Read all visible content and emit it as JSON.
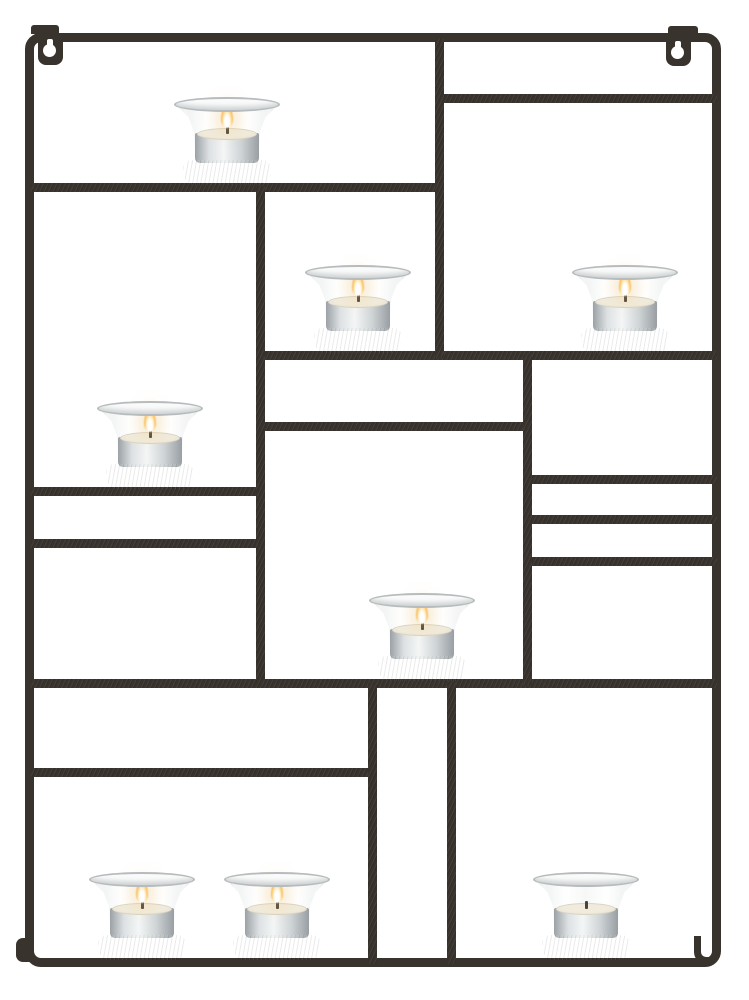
{
  "scene": {
    "description": "Wall-mounted dark metal tealight candle holder with a rectangular Mondrian-style grid frame, two keyhole wall hangers at the top, and eight clear glass votive cups on small shelves; seven tealights are lit and one is unlit, photographed on a plain white background.",
    "colors": {
      "bg": "#ffffff",
      "frame": "#39332e",
      "ring": "#3c332a",
      "glassEdge": "#b6bbbd",
      "wax": "#f0ebdd",
      "flame": "#f6b049"
    },
    "candle_count": 8,
    "lit_count": 7
  },
  "frame": {
    "outer": {
      "x": 25,
      "y": 33,
      "w": 696,
      "h": 934
    },
    "thickness": 9,
    "bars": [
      {
        "id": "top-shelf-left",
        "dir": "h",
        "x": 30,
        "y": 183,
        "len": 414
      },
      {
        "id": "top-right-divider",
        "dir": "h",
        "x": 435,
        "y": 94,
        "len": 282
      },
      {
        "id": "middle-shelf",
        "dir": "h",
        "x": 256,
        "y": 351,
        "len": 461
      },
      {
        "id": "center-lower-bar",
        "dir": "h",
        "x": 256,
        "y": 422,
        "len": 276
      },
      {
        "id": "left-shelf",
        "dir": "h",
        "x": 30,
        "y": 487,
        "len": 235
      },
      {
        "id": "left-lower-bar",
        "dir": "h",
        "x": 30,
        "y": 539,
        "len": 235
      },
      {
        "id": "right-ladder-1",
        "dir": "h",
        "x": 523,
        "y": 475,
        "len": 194
      },
      {
        "id": "right-ladder-2",
        "dir": "h",
        "x": 523,
        "y": 515,
        "len": 194
      },
      {
        "id": "right-ladder-3",
        "dir": "h",
        "x": 523,
        "y": 557,
        "len": 194
      },
      {
        "id": "bottom-shelf",
        "dir": "h",
        "x": 30,
        "y": 679,
        "len": 687
      },
      {
        "id": "bottom-left-divider",
        "dir": "h",
        "x": 30,
        "y": 768,
        "len": 347
      },
      {
        "id": "top-vertical",
        "dir": "v",
        "x": 435,
        "y": 38,
        "len": 320
      },
      {
        "id": "left-mid-vertical",
        "dir": "v",
        "x": 256,
        "y": 186,
        "len": 500
      },
      {
        "id": "right-mid-vertical",
        "dir": "v",
        "x": 523,
        "y": 354,
        "len": 332
      },
      {
        "id": "bottom-left-vertical",
        "dir": "v",
        "x": 368,
        "y": 682,
        "len": 282
      },
      {
        "id": "bottom-right-vertical",
        "dir": "v",
        "x": 447,
        "y": 682,
        "len": 282
      }
    ],
    "hangers": [
      {
        "id": "left",
        "plate": {
          "x": 38,
          "y": 37,
          "w": 25,
          "h": 28
        },
        "tab": {
          "x": 31,
          "y": 25,
          "w": 28,
          "h": 9
        },
        "circle": {
          "x": 43,
          "y": 44,
          "d": 13
        },
        "slot": {
          "x": 47,
          "y": 39,
          "w": 6,
          "h": 10
        }
      },
      {
        "id": "right",
        "plate": {
          "x": 666,
          "y": 38,
          "w": 25,
          "h": 28
        },
        "tab": {
          "x": 668,
          "y": 26,
          "w": 30,
          "h": 8
        },
        "circle": {
          "x": 671,
          "y": 46,
          "d": 13
        },
        "slot": {
          "x": 675,
          "y": 41,
          "w": 6,
          "h": 10
        }
      }
    ],
    "feet": [
      {
        "id": "bottom-left-foot",
        "x": 16,
        "y": 938,
        "w": 14,
        "h": 24
      },
      {
        "id": "bottom-right-hook",
        "x": 694,
        "y": 936,
        "w": 17,
        "h": 28
      }
    ]
  },
  "candles": [
    {
      "id": "top-left",
      "cx": 227,
      "base_y": 183,
      "lit": true
    },
    {
      "id": "mid-left",
      "cx": 150,
      "base_y": 487,
      "lit": true
    },
    {
      "id": "center",
      "cx": 358,
      "base_y": 351,
      "lit": true
    },
    {
      "id": "mid-right",
      "cx": 625,
      "base_y": 351,
      "lit": true
    },
    {
      "id": "center-bottom",
      "cx": 422,
      "base_y": 679,
      "lit": true
    },
    {
      "id": "bottom-left",
      "cx": 142,
      "base_y": 958,
      "lit": true
    },
    {
      "id": "bottom-center",
      "cx": 277,
      "base_y": 958,
      "lit": true
    },
    {
      "id": "bottom-right",
      "cx": 586,
      "base_y": 958,
      "lit": false
    }
  ]
}
